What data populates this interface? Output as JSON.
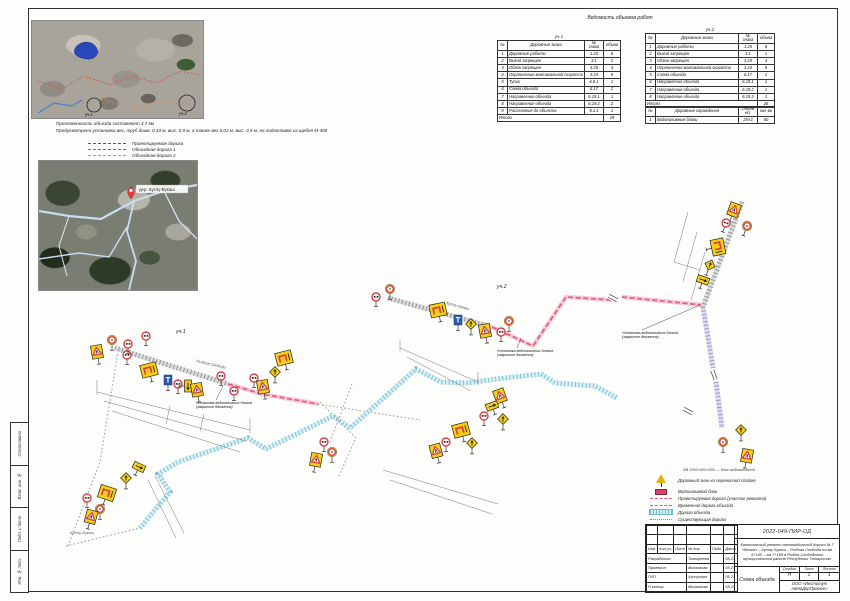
{
  "tables": {
    "title": "Ведомость объемов работ",
    "section1": {
      "caption": "уч.1",
      "columns": [
        "№",
        "Дорожные знаки",
        "№ знака",
        "объем"
      ],
      "rows": [
        [
          "1",
          "Дорожные работы",
          "1.25",
          "8"
        ],
        [
          "2",
          "Выезд запрещен",
          "3.1",
          "2"
        ],
        [
          "3",
          "Обгон запрещен",
          "3.20",
          "4"
        ],
        [
          "4",
          "Ограничение максимальной скорости",
          "3.24",
          "8"
        ],
        [
          "5",
          "Тупик",
          "6.8.1",
          "1"
        ],
        [
          "6",
          "Схема объезда",
          "6.17",
          "2"
        ],
        [
          "7",
          "Направление объезда",
          "6.19.1",
          "1"
        ],
        [
          "8",
          "Направление объезда",
          "6.19.2",
          "2"
        ],
        [
          "9",
          "Расстояние до объекта",
          "8.1.1",
          "1"
        ]
      ],
      "total_label": "Итого",
      "total_value": "29"
    },
    "section2": {
      "caption": "уч.2",
      "columns": [
        "№",
        "Дорожные знаки",
        "№ знака",
        "объем"
      ],
      "rows": [
        [
          "1",
          "Дорожные работы",
          "1.25",
          "8"
        ],
        [
          "2",
          "Выезд запрещен",
          "3.1",
          "1"
        ],
        [
          "3",
          "Обгон запрещен",
          "3.20",
          "4"
        ],
        [
          "4",
          "Ограничение максимальной скорости",
          "3.24",
          "8"
        ],
        [
          "5",
          "Схема объезда",
          "6.17",
          "2"
        ],
        [
          "6",
          "Направление объезда",
          "6.19.1",
          "1"
        ],
        [
          "7",
          "Направление объезда",
          "6.19.2",
          "1"
        ],
        [
          "8",
          "Направление объезда",
          "6.19.3",
          "1"
        ]
      ],
      "total_label": "Итого",
      "total_value": "26"
    },
    "barriers": {
      "columns": [
        "№",
        "Дорожные ограждения",
        "Объем ед.",
        "кол-во"
      ],
      "rows": [
        [
          "1",
          "Водоналивные блоки",
          "25×2",
          "50"
        ]
      ]
    }
  },
  "notes": {
    "line1": "Протяженность объезда составляет 4,7 км",
    "line2": "Предусмотрена установка вех, труб диам. 0,33 м, выс. 0,9 м, а также вех 0,02 м, выс. 0,9 м, на подготовке из щебня М-400"
  },
  "map_legend": {
    "items": [
      {
        "style": "dark",
        "label": "Проектируемая дорога"
      },
      {
        "style": "blue",
        "label": "Объездная дорога 1"
      },
      {
        "style": "blue2",
        "label": "Объездная дорога 2"
      }
    ]
  },
  "maps": {
    "map1": {
      "marker1_label": "уч.1",
      "marker2_label": "уч.2"
    },
    "map2": {
      "pin_label": "дер. Кутлу-Букаш"
    }
  },
  "scheme": {
    "section_labels": [
      {
        "x": 176,
        "y": 333,
        "text": "уч.1"
      },
      {
        "x": 497,
        "y": 288,
        "text": "уч.2"
      }
    ],
    "place_labels": [
      {
        "x": 70,
        "y": 534,
        "text": "Кутлу-Букаш"
      },
      {
        "x": 196,
        "y": 362,
        "r": 13,
        "text": "Рыбная Слобода"
      },
      {
        "x": 446,
        "y": 304,
        "r": 15,
        "text": "Кутлу-Букаш"
      }
    ],
    "annotations": [
      {
        "x": 196,
        "y": 404,
        "lx": 223,
        "ly": 386,
        "lines": [
          "Установка водоналивных блоков",
          "(закрытие движения)"
        ]
      },
      {
        "x": 497,
        "y": 352,
        "lx": 521,
        "ly": 338,
        "lines": [
          "Установка водоналивных блоков",
          "(закрытие движения)"
        ]
      },
      {
        "x": 622,
        "y": 334,
        "lx": 700,
        "ly": 305,
        "lines": [
          "Установка водоналивных блоков",
          "(закрытие движения)"
        ]
      }
    ],
    "legend": {
      "note": "БВ 2000×500×800 — блок водоналивной",
      "items": [
        {
          "icon": "sign",
          "label": "Дорожный знак на переносной стойке"
        },
        {
          "icon": "block",
          "label": "Водоналивной блок"
        },
        {
          "icon": "pink",
          "label": "Проектируемая дорога (участок ремонта)"
        },
        {
          "icon": "dash",
          "label": "Временная дорога объезда"
        },
        {
          "icon": "cyan",
          "label": "Дорога объезда"
        },
        {
          "icon": "dots",
          "label": "Существующая дорога"
        }
      ]
    },
    "roads": [
      {
        "type": "gray",
        "pts": "115,348 228,384"
      },
      {
        "type": "pink",
        "pts": "228,384 262,394 318,404"
      },
      {
        "type": "dot",
        "pts": "318,404 420,420"
      },
      {
        "type": "gray",
        "pts": "388,298 492,327"
      },
      {
        "type": "pink",
        "pts": "492,327 533,346 566,297 612,300"
      },
      {
        "type": "pink",
        "pts": "622,297 703,305"
      },
      {
        "type": "gray",
        "pts": "742,202 703,307"
      },
      {
        "type": "purple",
        "pts": "703,307 713,368"
      },
      {
        "type": "purple",
        "pts": "716,382 722,428"
      },
      {
        "type": "cyan",
        "pts": "140,528 170,492 158,474 178,462 248,438 266,449 333,416 350,428 416,369 441,382 468,383 497,379 541,374 555,383 595,386 617,398"
      },
      {
        "type": "dot",
        "pts": "66,546 140,528"
      },
      {
        "type": "dot",
        "pts": "68,546 100,462 118,352"
      },
      {
        "type": "dot",
        "pts": "320,402 356,438 338,478"
      },
      {
        "type": "dot",
        "pts": "352,384 330,442"
      }
    ],
    "breaks": [
      {
        "x": 613,
        "y": 298,
        "r": -62
      },
      {
        "x": 688,
        "y": 411,
        "r": -62
      },
      {
        "x": 714,
        "y": 375,
        "r": -20
      }
    ],
    "dims": [
      "97,392 250,430",
      "104,401 246,441",
      "112,411 240,452",
      "97,380 97,395",
      "250,418 250,433",
      "170,406 166,424",
      "204,414 200,431",
      "400,348 478,382",
      "407,357 471,391",
      "400,340 400,351",
      "478,372 478,385",
      "383,470 498,504",
      "390,480 492,514",
      "148,480 176,538",
      "155,476 184,533",
      "688,212 674,262",
      "697,232 683,282",
      "705,252 691,300",
      "674,262 700,270"
    ],
    "signs": [
      {
        "t": "tri",
        "x": 97,
        "y": 352,
        "r": -10
      },
      {
        "t": "roundY",
        "x": 112,
        "y": 340
      },
      {
        "t": "round",
        "x": 127,
        "y": 355
      },
      {
        "t": "round",
        "x": 128,
        "y": 344
      },
      {
        "t": "round",
        "x": 146,
        "y": 336
      },
      {
        "t": "board",
        "x": 149,
        "y": 370,
        "r": -14
      },
      {
        "t": "blue",
        "x": 168,
        "y": 380
      },
      {
        "t": "round",
        "x": 178,
        "y": 384
      },
      {
        "t": "sboard",
        "x": 188,
        "y": 386,
        "r": 90
      },
      {
        "t": "tri",
        "x": 197,
        "y": 390,
        "r": -10
      },
      {
        "t": "board",
        "x": 284,
        "y": 358,
        "r": -14
      },
      {
        "t": "diam",
        "x": 275,
        "y": 372
      },
      {
        "t": "round",
        "x": 254,
        "y": 378
      },
      {
        "t": "tri",
        "x": 263,
        "y": 387,
        "r": -10
      },
      {
        "t": "round",
        "x": 221,
        "y": 376
      },
      {
        "t": "round",
        "x": 234,
        "y": 391
      },
      {
        "t": "round",
        "x": 376,
        "y": 297
      },
      {
        "t": "roundY",
        "x": 390,
        "y": 289
      },
      {
        "t": "board",
        "x": 438,
        "y": 310,
        "r": -12
      },
      {
        "t": "blue",
        "x": 458,
        "y": 320
      },
      {
        "t": "diam",
        "x": 471,
        "y": 324
      },
      {
        "t": "tri",
        "x": 485,
        "y": 331,
        "r": -10
      },
      {
        "t": "round",
        "x": 501,
        "y": 332
      },
      {
        "t": "roundY",
        "x": 509,
        "y": 321
      },
      {
        "t": "tri",
        "x": 500,
        "y": 396,
        "r": -20
      },
      {
        "t": "sboard",
        "x": 492,
        "y": 406,
        "r": -20
      },
      {
        "t": "round",
        "x": 484,
        "y": 416
      },
      {
        "t": "diam",
        "x": 503,
        "y": 419
      },
      {
        "t": "board",
        "x": 461,
        "y": 430,
        "r": -15
      },
      {
        "t": "round",
        "x": 446,
        "y": 442
      },
      {
        "t": "tri",
        "x": 436,
        "y": 451,
        "r": -15
      },
      {
        "t": "diam",
        "x": 472,
        "y": 443
      },
      {
        "t": "round",
        "x": 324,
        "y": 442
      },
      {
        "t": "roundY",
        "x": 332,
        "y": 452
      },
      {
        "t": "tri",
        "x": 316,
        "y": 460,
        "r": 10
      },
      {
        "t": "tri",
        "x": 734,
        "y": 210,
        "r": 20
      },
      {
        "t": "round",
        "x": 726,
        "y": 223,
        "r": 20
      },
      {
        "t": "roundY",
        "x": 747,
        "y": 226,
        "r": 20
      },
      {
        "t": "board",
        "x": 718,
        "y": 247,
        "r": 78
      },
      {
        "t": "diam",
        "x": 710,
        "y": 265,
        "r": 20
      },
      {
        "t": "sboard",
        "x": 703,
        "y": 280,
        "r": 20
      },
      {
        "t": "diam",
        "x": 741,
        "y": 430
      },
      {
        "t": "roundY",
        "x": 723,
        "y": 442
      },
      {
        "t": "tri",
        "x": 747,
        "y": 456,
        "r": 10
      },
      {
        "t": "sboard",
        "x": 139,
        "y": 467,
        "r": 25
      },
      {
        "t": "diam",
        "x": 126,
        "y": 478
      },
      {
        "t": "board",
        "x": 107,
        "y": 493,
        "r": 18
      },
      {
        "t": "round",
        "x": 87,
        "y": 498
      },
      {
        "t": "roundY",
        "x": 100,
        "y": 509
      },
      {
        "t": "tri",
        "x": 91,
        "y": 517,
        "r": 15
      }
    ]
  },
  "titleblock": {
    "code": "2022-049-ПИР-ОД",
    "project": "Капитальный ремонт автомобильной дороги М-7 «Волга» – Кутлу-Букаш – Рыбная Слобода на км 6+100 – км 7+189 в Рыбно-Слободском муниципальном районе Республики Татарстан",
    "cols_header": [
      "Изм.",
      "Кол.уч.",
      "Лист",
      "№ док.",
      "Подп.",
      "Дата"
    ],
    "people": [
      [
        "Разработал",
        "Тимофеева",
        "05.23"
      ],
      [
        "Проверил",
        "Мингазова",
        "05.23"
      ],
      [
        "ГИП",
        "Хуснуллин",
        "05.23"
      ],
      [
        "Н.контр.",
        "Мингазова",
        "05.23"
      ]
    ],
    "stage_labels": [
      "Стадия",
      "Лист",
      "Листов"
    ],
    "stage_values": [
      "П",
      "1",
      "1"
    ],
    "sheet_title": "Схема объезда",
    "org": "ООО «Институт АвтоДорПроект»"
  },
  "side_stamp": {
    "labels": [
      "Согласовано",
      "Взам. инв. №",
      "Подп. и дата",
      "Инв. № подл."
    ]
  }
}
